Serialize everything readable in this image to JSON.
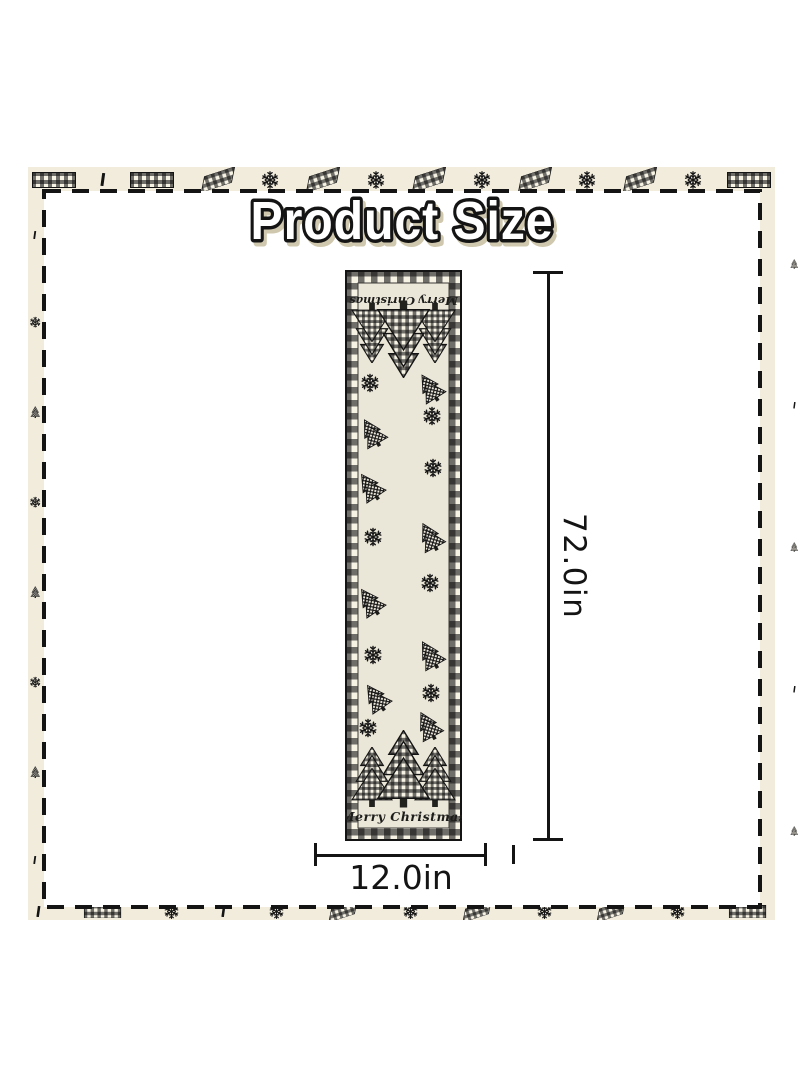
{
  "title": "Product Size",
  "measurements": {
    "height_label": "72.0in",
    "width_label": "12.0in"
  },
  "runner": {
    "top_text": "Merry Christmas",
    "bottom_text": "Merry Christmas"
  },
  "colors": {
    "page_bg": "#ffffff",
    "border_band": "#f1ecdc",
    "runner_fabric": "#ebe7d8",
    "ink": "#141414",
    "title_fill": "#ffffff",
    "title_outline": "#141414",
    "title_shadow": "#cfc8ae"
  },
  "icons": {
    "snowflake": "flake",
    "plaid_tree_large": "sym-tree-big",
    "plaid_tree_small": "sym-tree-small",
    "plaid_ribbon": "sym-ribbon",
    "plaid_block": "sym-block",
    "tick_mark": "sym-tick"
  },
  "frame_motifs": {
    "top": [
      "block",
      "tick",
      "block",
      "ribbon",
      "flake",
      "ribbon",
      "flake",
      "ribbon",
      "flake",
      "ribbon",
      "flake",
      "ribbon",
      "flake",
      "block"
    ],
    "bottom": [
      "tick",
      "block",
      "flake",
      "tick",
      "flake",
      "ribbon",
      "flake",
      "ribbon",
      "flake",
      "ribbon",
      "flake",
      "block"
    ],
    "left": [
      "tick",
      "flake",
      "tree",
      "flake",
      "tree",
      "flake",
      "tree",
      "tick"
    ],
    "right": [
      "tree",
      "tick",
      "tree",
      "tick",
      "tree"
    ]
  },
  "scatter": [
    {
      "type": "flake",
      "x": 25,
      "y": 113
    },
    {
      "type": "tree",
      "x": 85,
      "y": 118,
      "r": -32
    },
    {
      "type": "flake",
      "x": 87,
      "y": 146
    },
    {
      "type": "tree",
      "x": 27,
      "y": 163,
      "r": -30
    },
    {
      "type": "flake",
      "x": 88,
      "y": 198
    },
    {
      "type": "tree",
      "x": 25,
      "y": 217,
      "r": -34
    },
    {
      "type": "flake",
      "x": 28,
      "y": 267
    },
    {
      "type": "tree",
      "x": 85,
      "y": 267,
      "r": -28
    },
    {
      "type": "flake",
      "x": 85,
      "y": 313
    },
    {
      "type": "tree",
      "x": 25,
      "y": 332,
      "r": -34
    },
    {
      "type": "flake",
      "x": 28,
      "y": 385
    },
    {
      "type": "tree",
      "x": 85,
      "y": 385,
      "r": -30
    },
    {
      "type": "tree",
      "x": 31,
      "y": 428,
      "r": -34
    },
    {
      "type": "flake",
      "x": 86,
      "y": 423
    },
    {
      "type": "flake",
      "x": 23,
      "y": 458
    },
    {
      "type": "tree",
      "x": 83,
      "y": 456,
      "r": -28
    }
  ]
}
